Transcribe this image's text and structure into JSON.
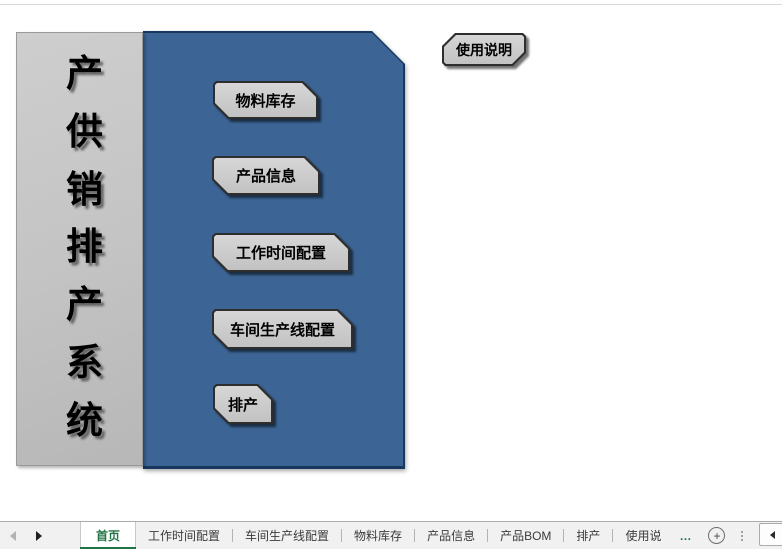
{
  "banner": {
    "title": "产供销排产系统",
    "chars": [
      "产",
      "供",
      "销",
      "排",
      "产",
      "系",
      "统"
    ]
  },
  "menu_buttons": [
    {
      "label": "物料库存"
    },
    {
      "label": "产品信息"
    },
    {
      "label": "工作时间配置"
    },
    {
      "label": "车间生产线配置"
    },
    {
      "label": "排产"
    }
  ],
  "help_button": {
    "label": "使用说明"
  },
  "sheet_bar": {
    "tabs": [
      {
        "label": "首页",
        "active": true
      },
      {
        "label": "工作时间配置"
      },
      {
        "label": "车间生产线配置"
      },
      {
        "label": "物料库存"
      },
      {
        "label": "产品信息"
      },
      {
        "label": "产品BOM"
      },
      {
        "label": "排产"
      },
      {
        "label": "使用说",
        "truncated": true
      }
    ],
    "overflow_indicator": "…",
    "add_sheet_label": "+"
  },
  "colors": {
    "panel_blue": "#3c6494",
    "panel_border": "#17375e",
    "button_gray": "#c9c9c9",
    "active_tab_green": "#217346"
  }
}
